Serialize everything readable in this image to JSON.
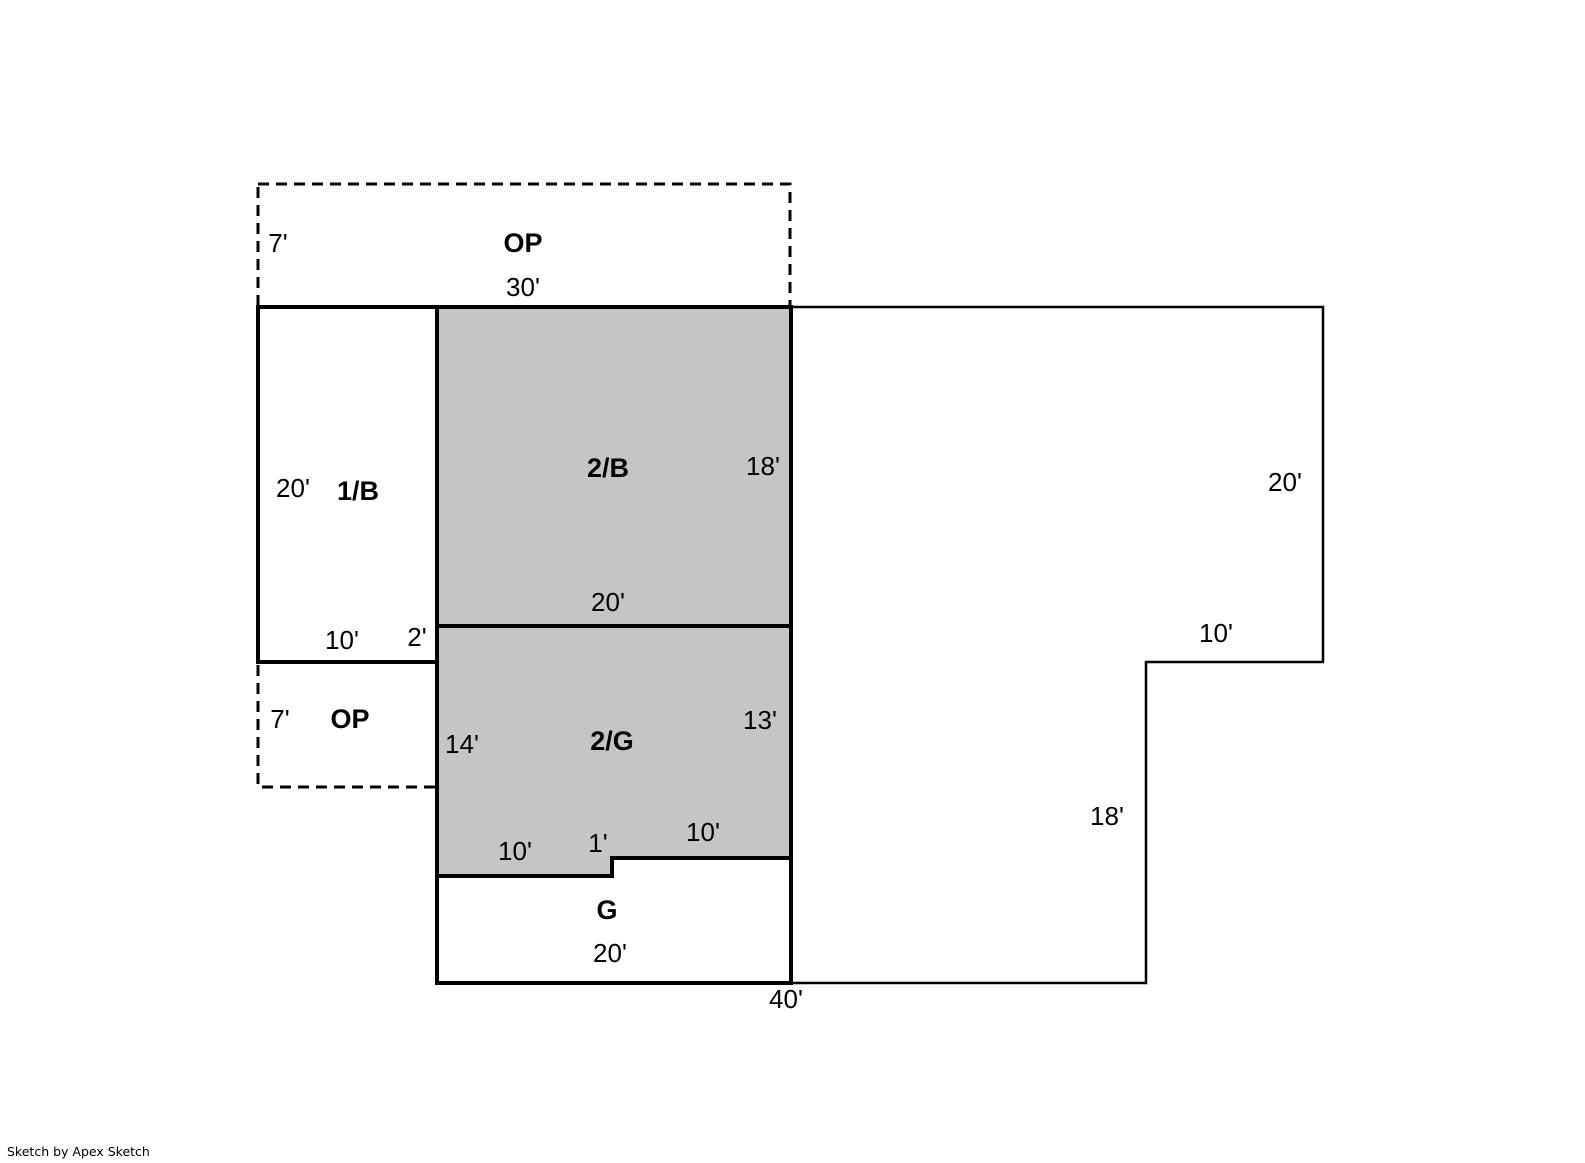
{
  "page": {
    "background": "#ffffff"
  },
  "footer": {
    "credit": "Sketch by Apex Sketch"
  },
  "sketch": {
    "width": 1585,
    "height": 1163,
    "wall_color": "#000000",
    "shaded_fill": "#c5c5c5",
    "white_fill": "#ffffff",
    "dash_pattern": "11,7",
    "dashed_stroke_width": 3,
    "dashed_areas": [
      {
        "name": "open-porch-top",
        "label": "OP",
        "points": [
          [
            258,
            184
          ],
          [
            790,
            184
          ],
          [
            790,
            307
          ],
          [
            258,
            307
          ]
        ]
      },
      {
        "name": "open-porch-lower",
        "label": "OP",
        "points": [
          [
            258,
            662
          ],
          [
            437,
            662
          ],
          [
            437,
            787
          ],
          [
            258,
            787
          ]
        ]
      }
    ],
    "areas": [
      {
        "name": "right-wing",
        "fill": "#ffffff",
        "stroke_width": 2.5,
        "points": [
          [
            791,
            307
          ],
          [
            1323,
            307
          ],
          [
            1323,
            662
          ],
          [
            1146,
            662
          ],
          [
            1146,
            983
          ],
          [
            791,
            983
          ]
        ]
      },
      {
        "name": "area-2B",
        "label": "2/B",
        "fill": "#c5c5c5",
        "stroke_width": 4,
        "points": [
          [
            437,
            307
          ],
          [
            791,
            307
          ],
          [
            791,
            626
          ],
          [
            437,
            626
          ]
        ]
      },
      {
        "name": "area-2G",
        "label": "2/G",
        "fill": "#c5c5c5",
        "stroke_width": 4,
        "points": [
          [
            437,
            626
          ],
          [
            791,
            626
          ],
          [
            791,
            858
          ],
          [
            612,
            858
          ],
          [
            612,
            876
          ],
          [
            437,
            876
          ]
        ]
      },
      {
        "name": "area-1B",
        "label": "1/B",
        "fill": "#ffffff",
        "stroke_width": 4,
        "points": [
          [
            258,
            307
          ],
          [
            437,
            307
          ],
          [
            437,
            662
          ],
          [
            258,
            662
          ]
        ]
      },
      {
        "name": "area-G",
        "label": "G",
        "fill": "#ffffff",
        "stroke_width": 4,
        "points": [
          [
            437,
            876
          ],
          [
            612,
            876
          ],
          [
            612,
            858
          ],
          [
            791,
            858
          ],
          [
            791,
            983
          ],
          [
            437,
            983
          ]
        ]
      }
    ],
    "labels": [
      {
        "name": "dim-op-top-height",
        "text": "7'",
        "x": 278,
        "y": 243,
        "bold": false
      },
      {
        "name": "label-op-top",
        "text": "OP",
        "x": 523,
        "y": 243,
        "bold": true
      },
      {
        "name": "dim-op-top-width",
        "text": "30'",
        "x": 523,
        "y": 287,
        "bold": false
      },
      {
        "name": "dim-1b-height",
        "text": "20'",
        "x": 293,
        "y": 488,
        "bold": false
      },
      {
        "name": "label-1b",
        "text": "1/B",
        "x": 358,
        "y": 491,
        "bold": true
      },
      {
        "name": "label-2b",
        "text": "2/B",
        "x": 608,
        "y": 468,
        "bold": true
      },
      {
        "name": "dim-2b-height",
        "text": "18'",
        "x": 763,
        "y": 466,
        "bold": false
      },
      {
        "name": "dim-2b-width",
        "text": "20'",
        "x": 608,
        "y": 602,
        "bold": false
      },
      {
        "name": "dim-1b-width",
        "text": "10'",
        "x": 342,
        "y": 640,
        "bold": false
      },
      {
        "name": "dim-2g-offset",
        "text": "2'",
        "x": 417,
        "y": 637,
        "bold": false
      },
      {
        "name": "dim-op-lower-height",
        "text": "7'",
        "x": 280,
        "y": 719,
        "bold": false
      },
      {
        "name": "label-op-lower",
        "text": "OP",
        "x": 350,
        "y": 719,
        "bold": true
      },
      {
        "name": "dim-2g-left",
        "text": "14'",
        "x": 462,
        "y": 744,
        "bold": false
      },
      {
        "name": "label-2g",
        "text": "2/G",
        "x": 612,
        "y": 741,
        "bold": true
      },
      {
        "name": "dim-2g-right",
        "text": "13'",
        "x": 760,
        "y": 720,
        "bold": false
      },
      {
        "name": "dim-2g-bottom-left",
        "text": "10'",
        "x": 515,
        "y": 851,
        "bold": false
      },
      {
        "name": "dim-2g-step",
        "text": "1'",
        "x": 598,
        "y": 843,
        "bold": false
      },
      {
        "name": "dim-2g-bottom-right",
        "text": "10'",
        "x": 703,
        "y": 832,
        "bold": false
      },
      {
        "name": "label-g",
        "text": "G",
        "x": 607,
        "y": 910,
        "bold": true
      },
      {
        "name": "dim-g-width",
        "text": "20'",
        "x": 610,
        "y": 953,
        "bold": false
      },
      {
        "name": "dim-bottom-total",
        "text": "40'",
        "x": 786,
        "y": 999,
        "bold": false
      },
      {
        "name": "dim-right-height",
        "text": "20'",
        "x": 1285,
        "y": 482,
        "bold": false
      },
      {
        "name": "dim-right-step-top",
        "text": "10'",
        "x": 1216,
        "y": 633,
        "bold": false
      },
      {
        "name": "dim-right-step-side",
        "text": "18'",
        "x": 1107,
        "y": 816,
        "bold": false
      }
    ],
    "label_font_size": 26,
    "bold_label_font_size": 27
  }
}
